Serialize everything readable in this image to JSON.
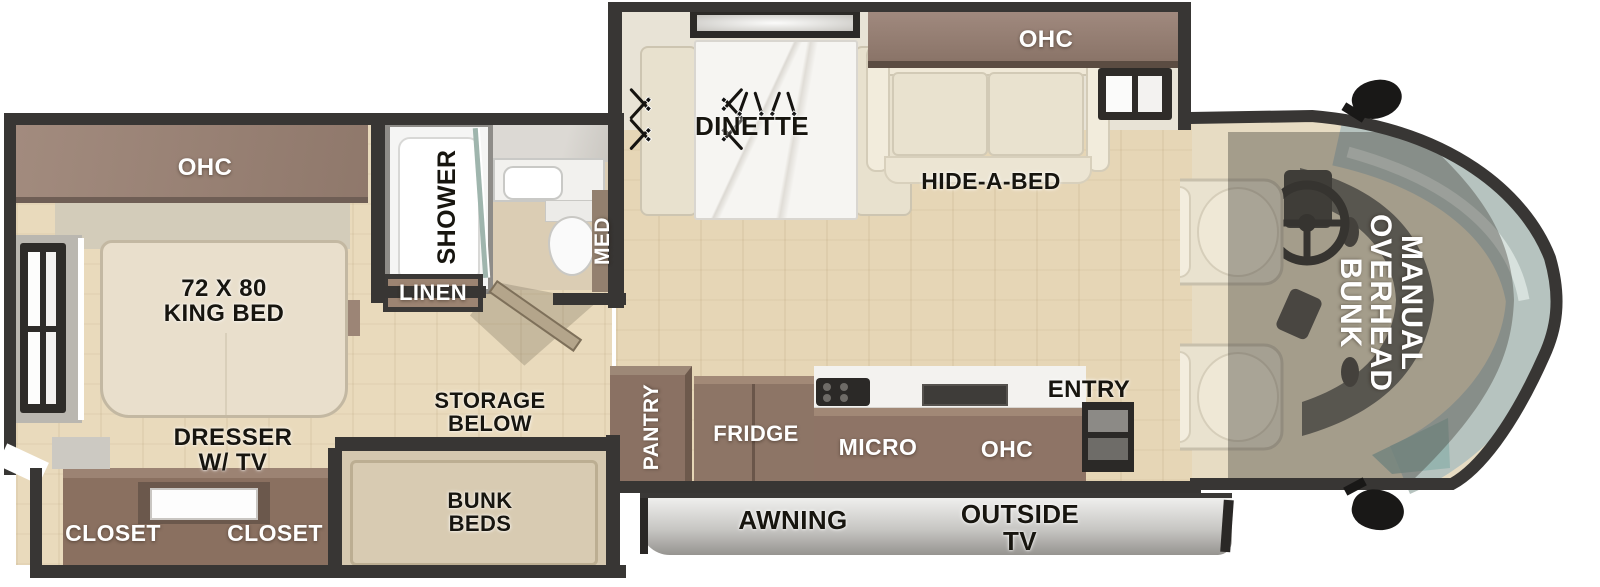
{
  "colors": {
    "wall": "#383634",
    "floor_main": "#e6d6b6",
    "floor_bedroom": "#e9dabc",
    "cabinet_brown": "#8d7566",
    "cabinet_brown_light": "#a18876",
    "upholstery_cream": "#eae3d0",
    "windshield": "#b6c3bf",
    "awning_silver": "#c9c8c5",
    "label_dark": "#17150f",
    "label_light": "#ffffff"
  },
  "bedroom": {
    "ohc": "OHC",
    "bed": "72 X 80\nKING BED",
    "dresser": "DRESSER\nW/ TV",
    "closet_left": "CLOSET",
    "closet_right": "CLOSET"
  },
  "bathroom": {
    "shower": "SHOWER",
    "med": "MED",
    "linen": "LINEN"
  },
  "midship": {
    "storage": "STORAGE\nBELOW",
    "bunks": "BUNK\nBEDS",
    "dinette": "DINETTE",
    "dinette_ohc": "OHC",
    "hide_a_bed": "HIDE-A-BED"
  },
  "kitchen": {
    "pantry": "PANTRY",
    "fridge": "FRIDGE",
    "micro": "MICRO",
    "ohc": "OHC",
    "entry": "ENTRY"
  },
  "exterior": {
    "awning": "AWNING",
    "outside_tv": "OUTSIDE\nTV"
  },
  "cab": {
    "overhead_bunk": "MANUAL\nOVERHEAD\nBUNK"
  }
}
